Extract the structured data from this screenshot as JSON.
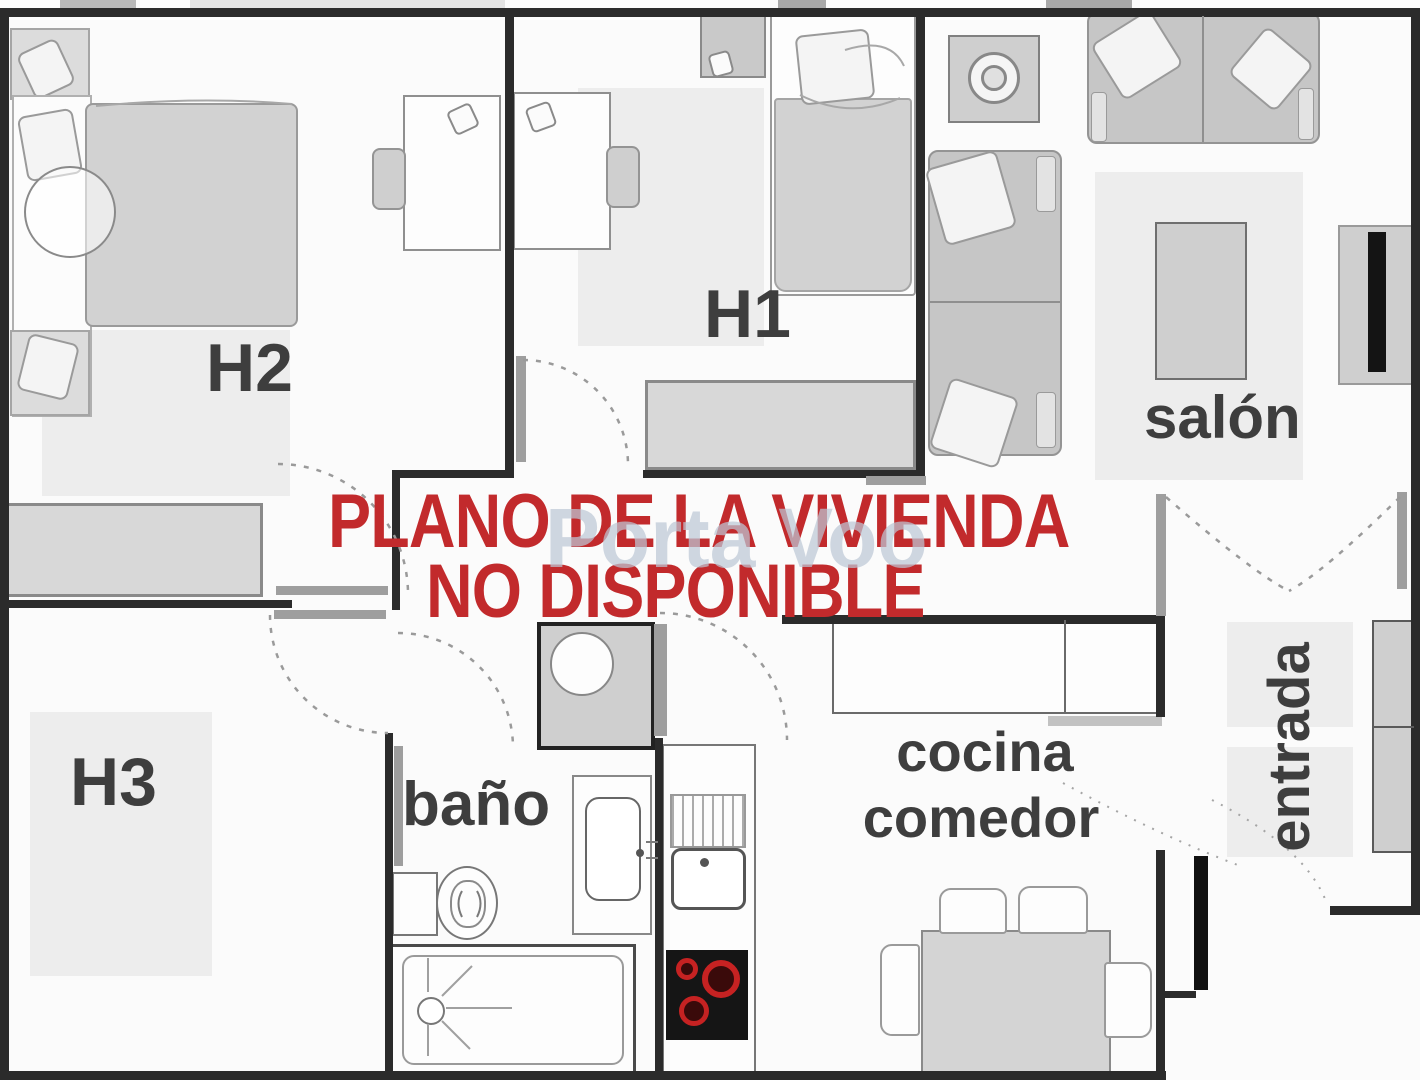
{
  "plan_title": "floor-plan",
  "watermark": {
    "line1": "PLANO DE LA VIVIENDA",
    "line2": "NO DISPONIBLE",
    "site": "Porta Voo"
  },
  "rooms": {
    "h1": "H1",
    "h2": "H2",
    "h3": "H3",
    "salon": "salón",
    "bano": "baño",
    "cocina_line1": "cocina",
    "cocina_line2": "comedor",
    "entrada": "entrada"
  },
  "palette": {
    "wall": "#2b2b2b",
    "red_text": "#c22a2c",
    "furniture": "#cdcdcd",
    "rug": "#ededed",
    "label": "#3e3e3e",
    "burner_red": "#c62222",
    "watermark": "#bdc7d5"
  }
}
